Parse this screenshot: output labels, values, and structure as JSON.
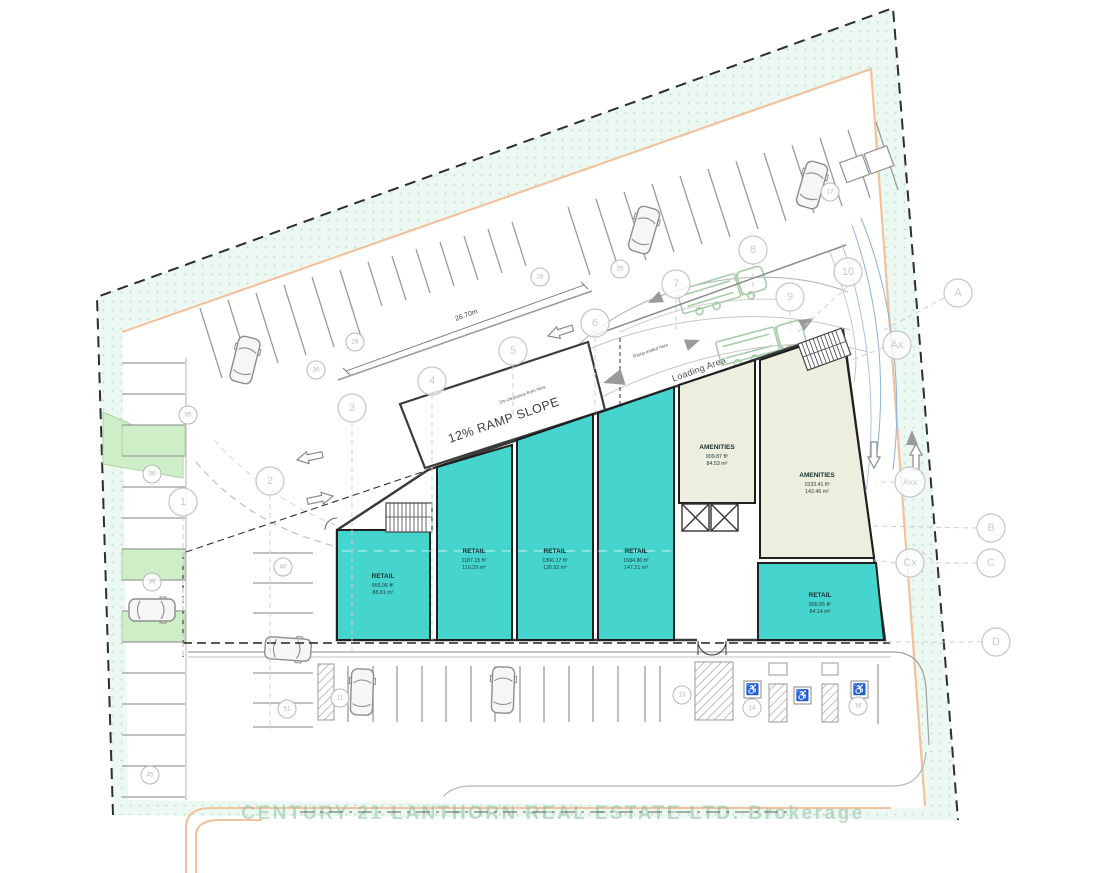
{
  "plan": {
    "watermark": "CENTURY 21 LANTHORN REAL ESTATE LTD. Brokerage",
    "labels": {
      "ramp_slope": "12% RAMP SLOPE",
      "loading_area": "Loading Area",
      "ramp_end_note": "Ramp ended here",
      "clearance_note": "2m clearance from here",
      "aisle_dimension": "26.70m"
    },
    "units": [
      {
        "name": "RETAIL",
        "area_ft": "955.96 ft²",
        "area_m": "88.81 m²"
      },
      {
        "name": "RETAIL",
        "area_ft": "1187.15 ft²",
        "area_m": "110.29 m²"
      },
      {
        "name": "RETAIL",
        "area_ft": "1366.17 ft²",
        "area_m": "126.92 m²"
      },
      {
        "name": "RETAIL",
        "area_ft": "1584.80 ft²",
        "area_m": "147.21 m²"
      },
      {
        "name": "RETAIL",
        "area_ft": "905.65 ft²",
        "area_m": "84.14 m²"
      }
    ],
    "amenities": [
      {
        "name": "AMENITIES",
        "area_ft": "909.87 ft²",
        "area_m": "84.53 m²"
      },
      {
        "name": "AMENITIES",
        "area_ft": "1533.41 ft²",
        "area_m": "142.46 m²"
      }
    ],
    "grid_numbers": [
      "1",
      "2",
      "3",
      "4",
      "5",
      "6",
      "7",
      "8",
      "9",
      "10"
    ],
    "grid_letters": [
      "A",
      "Ax",
      "Axx",
      "B",
      "Cx",
      "C",
      "D"
    ],
    "stall_numbers": [
      "35",
      "36",
      "39",
      "45",
      "40",
      "51",
      "30",
      "29",
      "28",
      "25",
      "17",
      "11",
      "13",
      "14",
      "16"
    ],
    "icons": {
      "accessible": "♿"
    }
  }
}
